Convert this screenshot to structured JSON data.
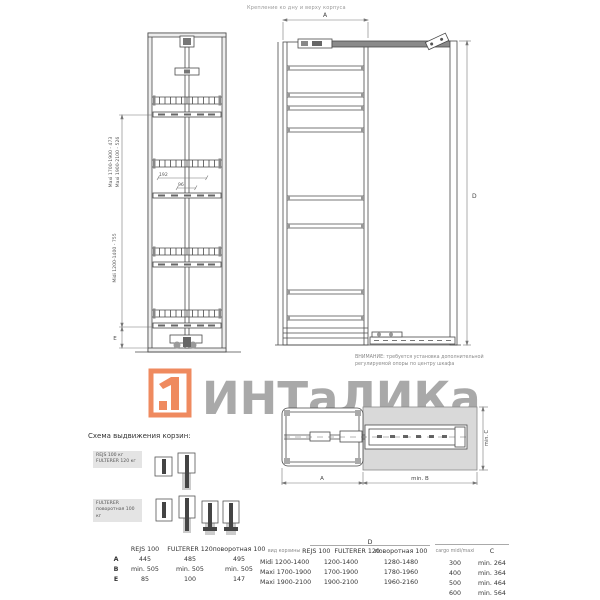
{
  "top_note": "Крепление ко дну и верху корпуса",
  "colors": {
    "brand_orange": "#EF8A5F",
    "watermark_gray": "#A9A9A9"
  },
  "front_view": {
    "labels": {
      "maxi1": "Maxi 1700-1900 - 473",
      "maxi2": "Maxi 1900-2100 - 526",
      "midi": "Midi 1200-1400 - 755",
      "dim_192": "192",
      "dim_96": "96",
      "dim_e": "E"
    }
  },
  "side_view": {
    "dim_a": "A",
    "dim_d": "D",
    "warning_line1": "ВНИМАНИЕ: требуется установка дополнительной",
    "warning_line2": "регулируемой опоры по центру шкафа"
  },
  "watermark": {
    "brand": "ИНТаЛИКа"
  },
  "plan_view": {
    "dim_a": "A",
    "dim_b": "min. B",
    "dim_c": "min. C"
  },
  "scheme": {
    "title": "Схема выдвижения корзин:",
    "label1_line1": "REJS 100 кг",
    "label1_line2": "FULTERER 120 кг",
    "label2_line1": "FULTERER",
    "label2_line2": "поворотная 100 кг"
  },
  "spec_table": {
    "col_headers": [
      "REJS 100",
      "FULTERER 120",
      "поворотная 100"
    ],
    "rows": [
      {
        "label": "A",
        "values": [
          "445",
          "485",
          "495"
        ]
      },
      {
        "label": "B",
        "values": [
          "min. 505",
          "min. 505",
          "min. 505"
        ]
      },
      {
        "label": "E",
        "values": [
          "85",
          "100",
          "147"
        ]
      }
    ]
  },
  "height_table": {
    "col1_header": "вид корзины",
    "group_header": "D",
    "col2_header": "REJS 100  FULTERER 120",
    "col3_header": "поворотная 100",
    "rows": [
      {
        "basket": "Midi 1200-1400",
        "d_standard": "1200-1400",
        "d_rotary": "1280-1480"
      },
      {
        "basket": "Maxi 1700-1900",
        "d_standard": "1700-1900",
        "d_rotary": "1780-1960"
      },
      {
        "basket": "Maxi 1900-2100",
        "d_standard": "1900-2100",
        "d_rotary": "1960-2160"
      }
    ]
  },
  "depth_table": {
    "col1_header": "cargo midi/maxi",
    "col2_header": "C",
    "rows": [
      {
        "width": "300",
        "c": "min. 264"
      },
      {
        "width": "400",
        "c": "min. 364"
      },
      {
        "width": "500",
        "c": "min. 464"
      },
      {
        "width": "600",
        "c": "min. 564"
      }
    ]
  }
}
